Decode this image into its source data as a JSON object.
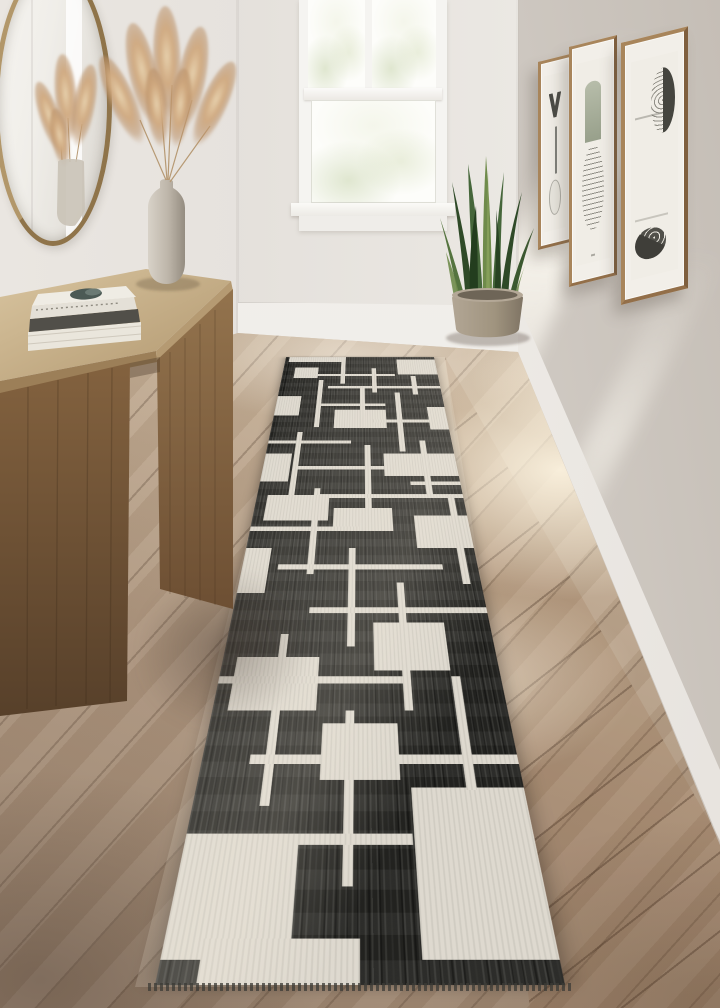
{
  "scene": {
    "type": "interior-photo",
    "room": "hallway with black-and-cream geometric runner rug",
    "objects": [
      "round-brass-mirror",
      "pampas-grass-vase",
      "wood-console-table",
      "book-stack",
      "double-hung-window",
      "snake-plant-in-pot",
      "three-framed-abstract-artworks",
      "wood-plank-floor",
      "geometric-runner-rug"
    ]
  },
  "colors": {
    "wallBack": "#e4e0db",
    "wallLeft": "#e6e2dd",
    "wallRight": "#d8d3cd",
    "baseboard": "#f4f2ee",
    "floorLight": "#dccab3",
    "floorDark": "#98816c",
    "floorSun": "#fcf3e0",
    "rugBlack": "#242421",
    "rugCream": "#ded9cf",
    "tableWoodLight": "#d2bd99",
    "tableWoodDark": "#6f5134",
    "frameWood": "#a8855b",
    "mirrorBrass": "#b2976a",
    "pampas": "#cfa87e",
    "vase": "#c6bfb3",
    "pot": "#a79b8b",
    "leafDark": "#2f4a28",
    "leafLight": "#6f8b4b"
  },
  "rug": {
    "style": "mid-century geometric lines and blocks, cream on black, with fringe at near end",
    "shapes": [
      [
        2.5,
        0,
        35,
        2
      ],
      [
        7.5,
        4.5,
        15.5,
        4.1
      ],
      [
        37.5,
        0,
        3,
        10.9
      ],
      [
        15,
        7,
        57.5,
        0.9
      ],
      [
        74.5,
        1.1,
        25.5,
        6.1
      ],
      [
        82.5,
        7.8,
        3,
        7
      ],
      [
        30,
        11.7,
        70,
        0.9
      ],
      [
        0,
        15.5,
        14.5,
        6.6
      ],
      [
        23.8,
        9.4,
        3,
        16.4
      ],
      [
        23.8,
        18,
        41.3,
        0.9
      ],
      [
        35,
        20.2,
        30,
        5.8
      ],
      [
        71.3,
        14.1,
        3,
        18.8
      ],
      [
        57.5,
        23.4,
        42.5,
        0.9
      ],
      [
        89.5,
        19.2,
        10.5,
        7.3
      ],
      [
        0,
        29.7,
        45,
        0.9
      ],
      [
        15,
        27.2,
        3,
        16.6
      ],
      [
        0,
        33.4,
        13.8,
        7.2
      ],
      [
        15,
        36.7,
        67.5,
        0.9
      ],
      [
        52.5,
        31.1,
        3,
        18.9
      ],
      [
        62.5,
        33.4,
        37.5,
        5.8
      ],
      [
        82.5,
        29.7,
        3,
        14.1
      ],
      [
        30,
        43.6,
        70,
        0.9
      ],
      [
        37.5,
        46.7,
        27.5,
        4.8
      ],
      [
        27.5,
        42.2,
        3,
        17.2
      ],
      [
        0,
        50.6,
        50,
        0.9
      ],
      [
        75,
        48.3,
        25,
        6.4
      ],
      [
        92.5,
        43.8,
        3,
        17.2
      ],
      [
        15,
        57.7,
        70,
        0.9
      ],
      [
        0,
        54.7,
        11.3,
        7.8
      ],
      [
        45,
        54.7,
        3,
        15.6
      ],
      [
        30,
        64.7,
        70,
        0.9
      ],
      [
        55,
        67,
        27.5,
        6.4
      ],
      [
        65,
        60.8,
        3,
        17.3
      ],
      [
        5,
        71.7,
        30,
        6.4
      ],
      [
        0,
        74.1,
        65,
        0.9
      ],
      [
        20,
        68.6,
        3,
        18.8
      ],
      [
        0,
        89.7,
        32.5,
        8.8
      ],
      [
        65.5,
        85.8,
        34.5,
        12.7
      ],
      [
        15,
        82.7,
        85,
        0.9
      ],
      [
        45,
        78.1,
        3,
        15.6
      ],
      [
        32.5,
        89.7,
        32.5,
        0.9
      ],
      [
        37.5,
        79.5,
        25,
        5.6
      ],
      [
        82.5,
        74.1,
        3,
        11.9
      ],
      [
        10,
        97.2,
        40,
        2.8
      ],
      [
        57.5,
        4.7,
        3,
        9.4
      ],
      [
        50,
        11.7,
        3,
        14.1
      ],
      [
        75,
        40.6,
        25,
        0.9
      ],
      [
        5,
        43.8,
        30,
        5.5
      ]
    ]
  },
  "artworks": [
    {
      "motif": "charcoal chevron with vertical line and faint arc"
    },
    {
      "motif": "sage arch over striped oval"
    },
    {
      "motif": "striped half-leaf and dark ripple disc"
    }
  ],
  "books": {
    "count": 3
  },
  "pampas": {
    "plumes": 7
  }
}
